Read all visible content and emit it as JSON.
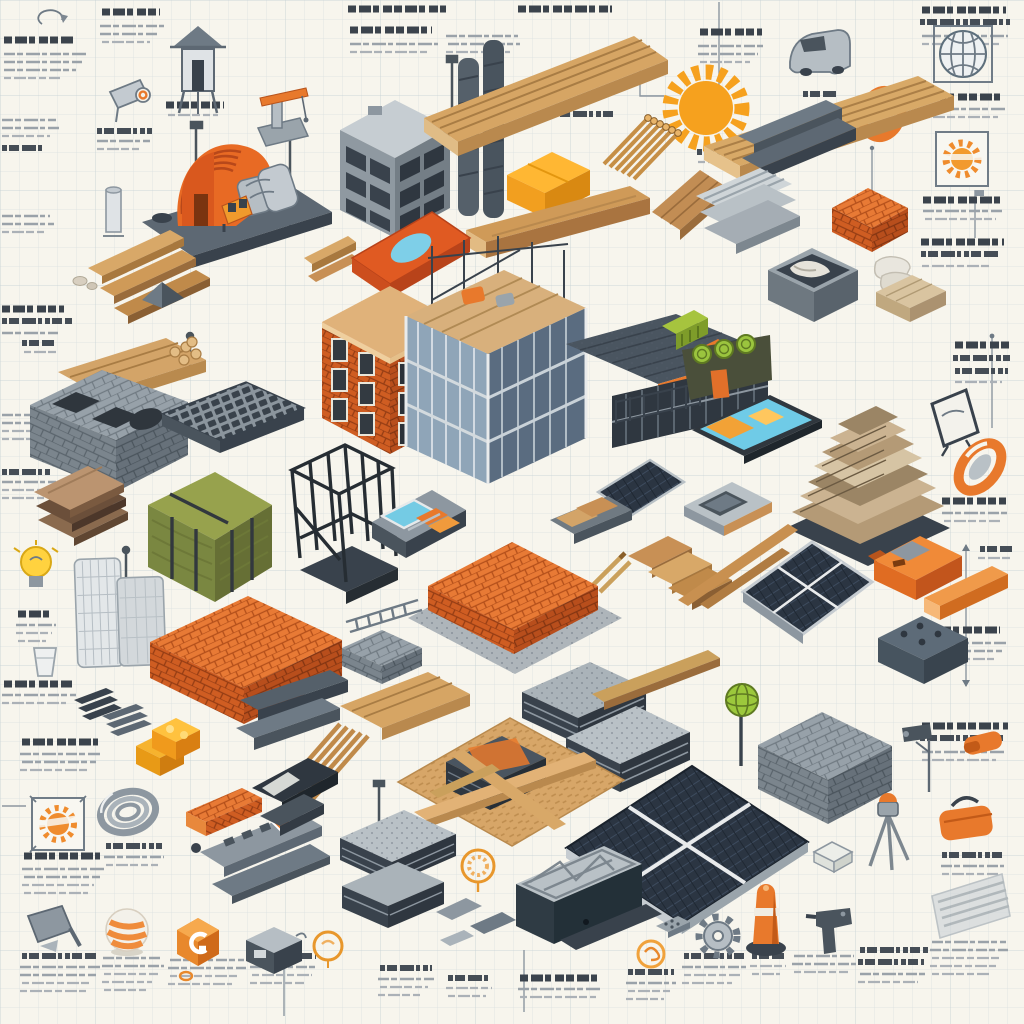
{
  "scene": {
    "title": "Construction Materials — Isometric Infographic",
    "subject": "Isometric collage of construction building materials and tools drawn on graph paper with sketch annotations",
    "style": "digital illustration, dimetric projection, blueprint-style callouts",
    "annotation_note": "all caption text in the artwork is illegible pseudo-text scribble"
  },
  "palette": {
    "paper": "#f7f5ed",
    "grid": "#b9c8d1",
    "accent_orange": "#e8762b",
    "brick_orange": "#cf5d22",
    "amber": "#ffc23f",
    "wood_light": "#d8a868",
    "wood_dark": "#9a6c3c",
    "steel_dark": "#39424c",
    "steel_mid": "#6e7a85",
    "concrete": "#9aa4ab",
    "insulation_green": "#8f9c45",
    "lime": "#9cc83c",
    "solar_cell": "#2b3542",
    "screen_cyan": "#6fcbe7",
    "sketch_ink": "#5d6f7c"
  },
  "annotations": {
    "block_count": 46,
    "legible_text": "",
    "style": "illegible scribble lines, bold headers with light body rows"
  },
  "objects": [
    {
      "name": "sun-icon",
      "label": "orange sunburst"
    },
    {
      "name": "quonset-shed",
      "label": "orange arched corrugated shed on slab"
    },
    {
      "name": "forklift",
      "label": "small amber forklift"
    },
    {
      "name": "watchtower-sketch",
      "label": "line-drawn watch tower"
    },
    {
      "name": "crane-sketch",
      "label": "small crane with orange boom"
    },
    {
      "name": "camera-sketch",
      "label": "survey camera sketch"
    },
    {
      "name": "rotate-arrow-icon",
      "label": "circular arrow doodle"
    },
    {
      "name": "truck-sketch",
      "label": "gray van sketch"
    },
    {
      "name": "blueprint-globe-sketch",
      "label": "framed blueprint sphere"
    },
    {
      "name": "ear-protection-icon",
      "label": "orange ring / ear muff icon"
    },
    {
      "name": "framed-sunburst-sketch",
      "label": "framed orange sun sketch"
    },
    {
      "name": "lumber-stack-top",
      "label": "long stacked lumber planks"
    },
    {
      "name": "lumber-stack-right",
      "label": "stacked lumber planks"
    },
    {
      "name": "dowel-bundle",
      "label": "bundle of wooden dowels"
    },
    {
      "name": "concrete-frame-building",
      "label": "unfinished concrete frame building"
    },
    {
      "name": "twin-columns",
      "label": "tall dark columns"
    },
    {
      "name": "yellow-block",
      "label": "amber insulation block"
    },
    {
      "name": "wood-beam",
      "label": "large timber beam"
    },
    {
      "name": "wood-panel",
      "label": "glued wood panel"
    },
    {
      "name": "orange-tile",
      "label": "orange tile with blue cutout"
    },
    {
      "name": "cinder-block",
      "label": "hollow concrete masonry unit"
    },
    {
      "name": "keyboard-slab",
      "label": "keyed formwork slab"
    },
    {
      "name": "wood-sandwich",
      "label": "layered wood sandwich panels"
    },
    {
      "name": "insulation-bale",
      "label": "green insulation bale with straps"
    },
    {
      "name": "steel-cage",
      "label": "welded rebar cage"
    },
    {
      "name": "skyscraper-sketch",
      "label": "light tower sketch"
    },
    {
      "name": "brick-stack-large",
      "label": "large orange brick stack"
    },
    {
      "name": "brick-cube",
      "label": "orange brick cube"
    },
    {
      "name": "brick-pad",
      "label": "brick mattress on gravel pad"
    },
    {
      "name": "brick-beam",
      "label": "brick lintel beam"
    },
    {
      "name": "brick-building",
      "label": "orange brick corner building"
    },
    {
      "name": "glass-building",
      "label": "steel and glass building under construction"
    },
    {
      "name": "roof-building",
      "label": "dark shingled roof hall with orange fascia"
    },
    {
      "name": "green-container",
      "label": "lime green rooftop container"
    },
    {
      "name": "pool-module",
      "label": "prefab module with blue pool"
    },
    {
      "name": "pallet",
      "label": "pallet with boards"
    },
    {
      "name": "mesh-panel",
      "label": "dark mesh screen panel"
    },
    {
      "name": "wood-steps",
      "label": "stepped wooden slabs"
    },
    {
      "name": "stick-pencils",
      "label": "loose wooden sticks"
    },
    {
      "name": "insulation-rolls",
      "label": "lime insulation rolls in crate"
    },
    {
      "name": "tablet-device",
      "label": "tablet with cyan screen"
    },
    {
      "name": "reclaimed-wood-pile",
      "label": "pyramid pile of reclaimed planks"
    },
    {
      "name": "display-frame-sketch",
      "label": "framed display sketch"
    },
    {
      "name": "ring-level",
      "label": "orange torus level"
    },
    {
      "name": "concrete-mold",
      "label": "concrete casting mold"
    },
    {
      "name": "plank-pair",
      "label": "two long planks"
    },
    {
      "name": "solar-panel-small",
      "label": "small solar panel"
    },
    {
      "name": "solar-panel-large",
      "label": "large solar array"
    },
    {
      "name": "orange-power-tool",
      "label": "orange power tool"
    },
    {
      "name": "orange-lumber",
      "label": "orange painted beam"
    },
    {
      "name": "foam-block",
      "label": "gray foam block with sockets"
    },
    {
      "name": "corrugated-sheets",
      "label": "corrugated metal sheets"
    },
    {
      "name": "channel-beams",
      "label": "steel channel beams"
    },
    {
      "name": "mortar-bin",
      "label": "mortar mixing bin"
    },
    {
      "name": "mortar-bags",
      "label": "white mortar bags and sand bricks"
    },
    {
      "name": "shingle-piles",
      "label": "asphalt shingle piles"
    },
    {
      "name": "osb-work-area",
      "label": "OSB board with slate stack and crossed planks"
    },
    {
      "name": "lumber-bundle",
      "label": "banded lumber bundle"
    },
    {
      "name": "slab-stacks",
      "label": "stacked roofing slabs"
    },
    {
      "name": "truss-formwork",
      "label": "truss inside dark formwork tray"
    },
    {
      "name": "block-cube",
      "label": "gray masonry block cube"
    },
    {
      "name": "globe-pole",
      "label": "lime globe on post"
    },
    {
      "name": "camera-pole-sketch",
      "label": "CCTV camera on pole"
    },
    {
      "name": "tripod-level",
      "label": "tripod laser level"
    },
    {
      "name": "tool-bag",
      "label": "orange tool bag"
    },
    {
      "name": "gear-sketch",
      "label": "gear doodle"
    },
    {
      "name": "bollard-cone",
      "label": "orange bollard"
    },
    {
      "name": "drill-sketch",
      "label": "power drill silhouette"
    },
    {
      "name": "metal-panel-sketch",
      "label": "ribbed metal panel ghost"
    },
    {
      "name": "coil-ring",
      "label": "steel wire coil"
    },
    {
      "name": "yellow-toy-blocks",
      "label": "amber modular blocks"
    },
    {
      "name": "level-ruler",
      "label": "machined level bars with orange diamond"
    },
    {
      "name": "hex-badge",
      "label": "orange hexagon badge with glyph"
    },
    {
      "name": "striped-ball",
      "label": "orange striped sphere"
    },
    {
      "name": "dustpan-sketch",
      "label": "gray scoop sketch"
    },
    {
      "name": "planter-box",
      "label": "small gray bin"
    },
    {
      "name": "badge-sketch",
      "label": "orange circular badge doodles"
    },
    {
      "name": "lightbulb-sketch",
      "label": "yellow light bulb doodle"
    },
    {
      "name": "ladder-sketch",
      "label": "flat ladder sketch"
    },
    {
      "name": "gray-block-stack",
      "label": "gray block stack"
    },
    {
      "name": "dowel-sticks",
      "label": "loose dowel rods"
    },
    {
      "name": "dark-boxes",
      "label": "dark cassette slabs"
    },
    {
      "name": "lamp-posts",
      "label": "thin survey poles"
    },
    {
      "name": "dimension-lines",
      "label": "blueprint dimension lines"
    }
  ]
}
